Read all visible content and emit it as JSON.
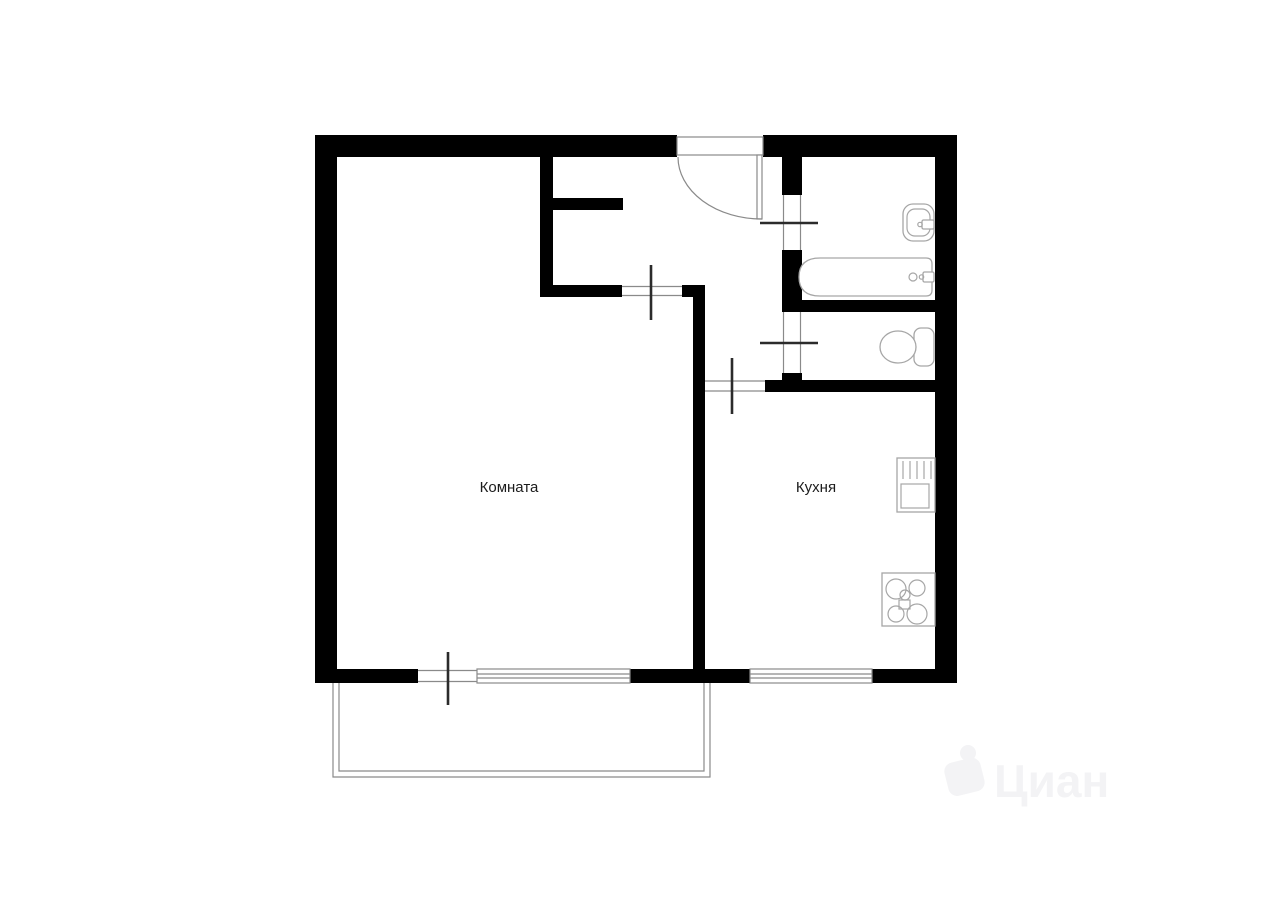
{
  "document": {
    "type": "apartment-floor-plan",
    "background": "#ffffff"
  },
  "rooms": {
    "room": {
      "label": "Комната"
    },
    "kitchen": {
      "label": "Кухня"
    }
  },
  "fixtures": [
    "entry-door",
    "room-door",
    "kitchen-door",
    "bathroom-door",
    "toilet-door",
    "balcony-door",
    "room-window",
    "kitchen-window",
    "washbasin",
    "bathtub",
    "toilet",
    "kitchen-sink",
    "stove",
    "balcony"
  ],
  "watermark": {
    "text": "Циан",
    "logo": "cian-figure-icon"
  },
  "colors": {
    "wall": "#000000",
    "thin_line": "#8a8a8a",
    "fixture_line": "#a6a6a6",
    "door_tick": "#2b2b2b",
    "label_text": "#1c1c1c",
    "watermark": "#f3f3f5",
    "background": "#ffffff"
  }
}
